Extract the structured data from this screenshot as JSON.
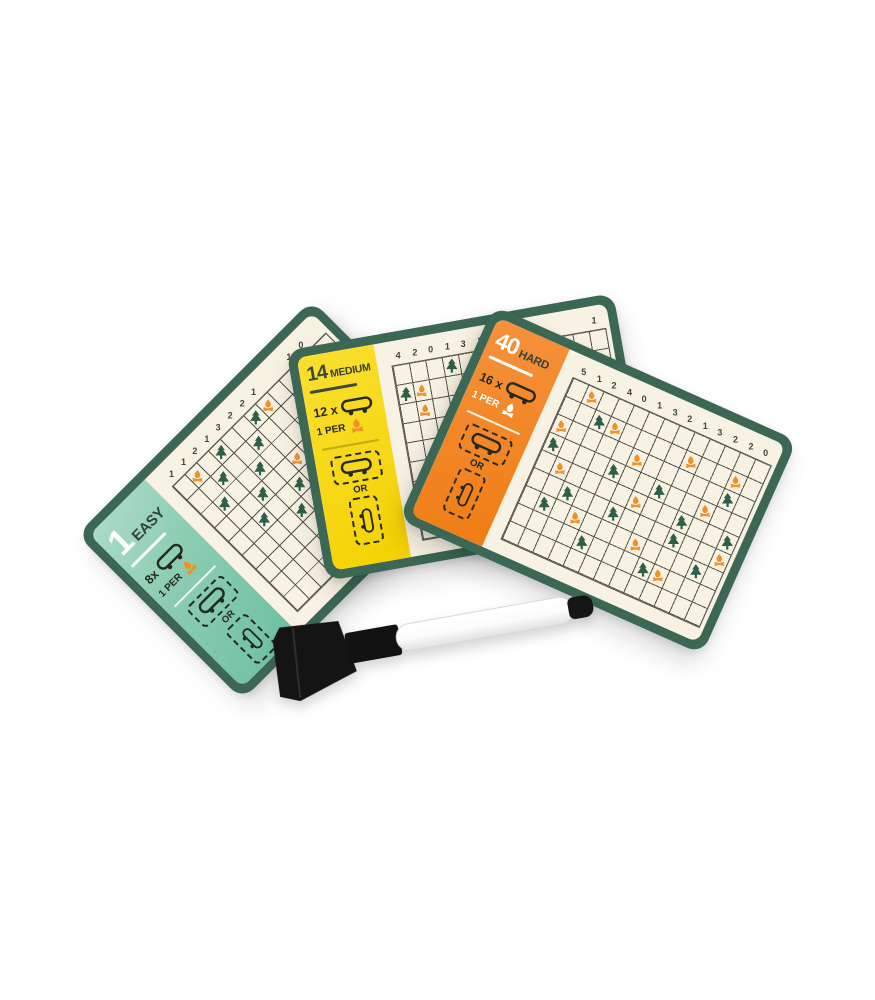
{
  "colors": {
    "background": "#ffffff",
    "card_border_green": "#3b6754",
    "card_cream": "#f8f2e4",
    "easy_band_teal": "#7fc7aa",
    "medium_band_yellow": "#f5d504",
    "hard_band_orange": "#f08020",
    "tree_green": "#2d5f4a",
    "campfire_orange": "#f29022",
    "grid_line": "#55534a",
    "marker_cap_black": "#141414",
    "marker_barrel_white": "#ffffff"
  },
  "cards": [
    {
      "id": "easy",
      "number": "1",
      "name": "EASY",
      "count": "8x",
      "per": "1 PER",
      "or": "OR",
      "grid": {
        "cols": [
          "1",
          "1",
          "2",
          "1",
          "3",
          "2",
          "2",
          "1",
          "",
          "",
          "1",
          "0",
          ""
        ],
        "rows": [
          "",
          "",
          "",
          "",
          "",
          "",
          "",
          "",
          ""
        ],
        "icons": [
          {
            "c": 2,
            "r": 1,
            "t": "fire"
          },
          {
            "c": 8,
            "r": 1,
            "t": "fire"
          },
          {
            "c": 7,
            "r": 4,
            "t": "fire"
          },
          {
            "c": 8,
            "r": 5,
            "t": "fire"
          },
          {
            "c": 4,
            "r": 1,
            "t": "tree"
          },
          {
            "c": 7,
            "r": 1,
            "t": "tree"
          },
          {
            "c": 3,
            "r": 2,
            "t": "tree"
          },
          {
            "c": 6,
            "r": 2,
            "t": "tree"
          },
          {
            "c": 2,
            "r": 3,
            "t": "tree"
          },
          {
            "c": 5,
            "r": 3,
            "t": "tree"
          },
          {
            "c": 4,
            "r": 4,
            "t": "tree"
          },
          {
            "c": 3,
            "r": 5,
            "t": "tree"
          },
          {
            "c": 6,
            "r": 5,
            "t": "tree"
          },
          {
            "c": 5,
            "r": 6,
            "t": "tree"
          },
          {
            "c": 7,
            "r": 6,
            "t": "tree"
          },
          {
            "c": 6,
            "r": 7,
            "t": "tree"
          }
        ]
      }
    },
    {
      "id": "medium",
      "number": "14",
      "name": "MEDIUM",
      "count": "12 x",
      "per": "1 PER",
      "or": "OR",
      "grid": {
        "cols": [
          "4",
          "2",
          "0",
          "1",
          "3",
          "2",
          "",
          "",
          "",
          "",
          "",
          "",
          "1"
        ],
        "rows": [
          "5",
          "",
          "",
          "",
          "",
          "",
          "",
          "",
          ""
        ],
        "icons": [
          {
            "c": 2,
            "r": 2,
            "t": "fire"
          },
          {
            "c": 2,
            "r": 3,
            "t": "fire"
          },
          {
            "c": 7,
            "r": 4,
            "t": "fire"
          },
          {
            "c": 2,
            "r": 8,
            "t": "fire"
          },
          {
            "c": 4,
            "r": 1,
            "t": "tree"
          },
          {
            "c": 1,
            "r": 2,
            "t": "tree"
          },
          {
            "c": 6,
            "r": 2,
            "t": "tree"
          },
          {
            "c": 4,
            "r": 3,
            "t": "tree"
          },
          {
            "c": 7,
            "r": 3,
            "t": "tree"
          },
          {
            "c": 3,
            "r": 4,
            "t": "tree"
          },
          {
            "c": 4,
            "r": 5,
            "t": "tree"
          },
          {
            "c": 5,
            "r": 6,
            "t": "tree"
          },
          {
            "c": 5,
            "r": 7,
            "t": "tree"
          }
        ]
      }
    },
    {
      "id": "hard",
      "number": "40",
      "name": "HARD",
      "count": "16 x",
      "per": "1 PER",
      "or": "OR",
      "grid": {
        "cols": [
          "5",
          "1",
          "2",
          "4",
          "0",
          "1",
          "3",
          "2",
          "1",
          "3",
          "2",
          "2",
          "0"
        ],
        "rows": [
          "6",
          "7",
          "3",
          "2",
          "6",
          "3",
          "3",
          "7",
          "1"
        ],
        "icons": [
          {
            "c": 2,
            "r": 1,
            "t": "fire"
          },
          {
            "c": 4,
            "r": 2,
            "t": "fire"
          },
          {
            "c": 9,
            "r": 2,
            "t": "fire"
          },
          {
            "c": 12,
            "r": 2,
            "t": "fire"
          },
          {
            "c": 1,
            "r": 3,
            "t": "fire"
          },
          {
            "c": 6,
            "r": 3,
            "t": "fire"
          },
          {
            "c": 11,
            "r": 4,
            "t": "fire"
          },
          {
            "c": 2,
            "r": 5,
            "t": "fire"
          },
          {
            "c": 7,
            "r": 5,
            "t": "fire"
          },
          {
            "c": 13,
            "r": 6,
            "t": "fire"
          },
          {
            "c": 4,
            "r": 7,
            "t": "fire"
          },
          {
            "c": 8,
            "r": 7,
            "t": "fire"
          },
          {
            "c": 10,
            "r": 8,
            "t": "fire"
          },
          {
            "c": 3,
            "r": 2,
            "t": "tree"
          },
          {
            "c": 12,
            "r": 3,
            "t": "tree"
          },
          {
            "c": 1,
            "r": 4,
            "t": "tree"
          },
          {
            "c": 5,
            "r": 4,
            "t": "tree"
          },
          {
            "c": 8,
            "r": 4,
            "t": "tree"
          },
          {
            "c": 10,
            "r": 5,
            "t": "tree"
          },
          {
            "c": 13,
            "r": 5,
            "t": "tree"
          },
          {
            "c": 3,
            "r": 6,
            "t": "tree"
          },
          {
            "c": 6,
            "r": 6,
            "t": "tree"
          },
          {
            "c": 10,
            "r": 6,
            "t": "tree"
          },
          {
            "c": 2,
            "r": 7,
            "t": "tree"
          },
          {
            "c": 12,
            "r": 7,
            "t": "tree"
          },
          {
            "c": 5,
            "r": 8,
            "t": "tree"
          },
          {
            "c": 9,
            "r": 8,
            "t": "tree"
          }
        ]
      }
    }
  ],
  "marker": {
    "description": "dry-erase marker with black cap and white barrel"
  }
}
